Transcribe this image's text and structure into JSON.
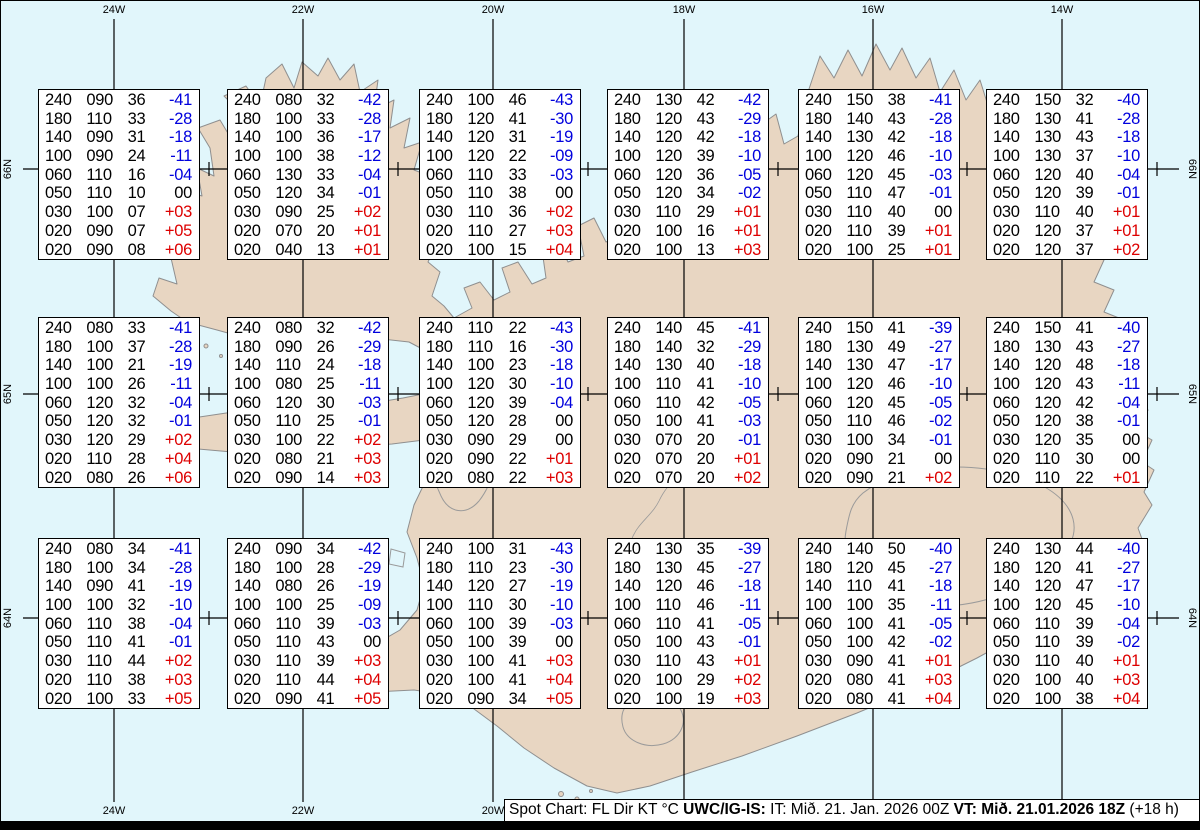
{
  "map": {
    "region": "Iceland",
    "colors": {
      "sea": "#e1f6fb",
      "land": "#e8d6c2",
      "coast": "#8f8f8f",
      "grid_line": "#000000",
      "temp_negative": "#0000dd",
      "temp_positive": "#dd0000",
      "temp_zero": "#000000"
    }
  },
  "grid": {
    "top_labels": [
      "24W",
      "22W",
      "20W",
      "18W",
      "16W",
      "14W"
    ],
    "bottom_labels": [
      "24W",
      "22W",
      "20W",
      "18W",
      "16W",
      "14W"
    ],
    "left_labels": [
      "66N",
      "65N",
      "64N"
    ],
    "right_labels": [
      "66N",
      "65N",
      "64N"
    ]
  },
  "status_bar": {
    "legend": "Spot Chart: FL Dir KT °C ",
    "source": "UWC/IG-IS:",
    "issue_time": " IT: Mið. 21. Jan. 2026 00Z ",
    "valid_time": "VT: Mið. 21.01.2026 18Z",
    "lead_time": " (+18 h)"
  },
  "spot_columns": [
    "FL",
    "Dir",
    "KT",
    "°C"
  ],
  "boxes": [
    {
      "rows": [
        [
          "240",
          "090",
          "36",
          "-41"
        ],
        [
          "180",
          "110",
          "33",
          "-28"
        ],
        [
          "140",
          "090",
          "31",
          "-18"
        ],
        [
          "100",
          "090",
          "24",
          "-11"
        ],
        [
          "060",
          "110",
          "16",
          "-04"
        ],
        [
          "050",
          "110",
          "10",
          "00"
        ],
        [
          "030",
          "100",
          "07",
          "+03"
        ],
        [
          "020",
          "090",
          "07",
          "+05"
        ],
        [
          "020",
          "090",
          "08",
          "+06"
        ]
      ]
    },
    {
      "rows": [
        [
          "240",
          "080",
          "32",
          "-42"
        ],
        [
          "180",
          "100",
          "33",
          "-28"
        ],
        [
          "140",
          "100",
          "36",
          "-17"
        ],
        [
          "100",
          "100",
          "38",
          "-12"
        ],
        [
          "060",
          "130",
          "33",
          "-04"
        ],
        [
          "050",
          "120",
          "34",
          "-01"
        ],
        [
          "030",
          "090",
          "25",
          "+02"
        ],
        [
          "020",
          "070",
          "20",
          "+01"
        ],
        [
          "020",
          "040",
          "13",
          "+01"
        ]
      ]
    },
    {
      "rows": [
        [
          "240",
          "100",
          "46",
          "-43"
        ],
        [
          "180",
          "120",
          "41",
          "-30"
        ],
        [
          "140",
          "120",
          "31",
          "-19"
        ],
        [
          "100",
          "120",
          "22",
          "-09"
        ],
        [
          "060",
          "110",
          "33",
          "-03"
        ],
        [
          "050",
          "110",
          "38",
          "00"
        ],
        [
          "030",
          "110",
          "36",
          "+02"
        ],
        [
          "020",
          "110",
          "27",
          "+03"
        ],
        [
          "020",
          "100",
          "15",
          "+04"
        ]
      ]
    },
    {
      "rows": [
        [
          "240",
          "130",
          "42",
          "-42"
        ],
        [
          "180",
          "120",
          "43",
          "-29"
        ],
        [
          "140",
          "120",
          "42",
          "-18"
        ],
        [
          "100",
          "120",
          "39",
          "-10"
        ],
        [
          "060",
          "120",
          "36",
          "-05"
        ],
        [
          "050",
          "120",
          "34",
          "-02"
        ],
        [
          "030",
          "110",
          "29",
          "+01"
        ],
        [
          "020",
          "100",
          "16",
          "+01"
        ],
        [
          "020",
          "100",
          "13",
          "+03"
        ]
      ]
    },
    {
      "rows": [
        [
          "240",
          "150",
          "38",
          "-41"
        ],
        [
          "180",
          "140",
          "43",
          "-28"
        ],
        [
          "140",
          "130",
          "42",
          "-18"
        ],
        [
          "100",
          "120",
          "46",
          "-10"
        ],
        [
          "060",
          "120",
          "45",
          "-03"
        ],
        [
          "050",
          "110",
          "47",
          "-01"
        ],
        [
          "030",
          "110",
          "40",
          "00"
        ],
        [
          "020",
          "110",
          "39",
          "+01"
        ],
        [
          "020",
          "100",
          "25",
          "+01"
        ]
      ]
    },
    {
      "rows": [
        [
          "240",
          "150",
          "32",
          "-40"
        ],
        [
          "180",
          "130",
          "41",
          "-28"
        ],
        [
          "140",
          "130",
          "43",
          "-18"
        ],
        [
          "100",
          "130",
          "37",
          "-10"
        ],
        [
          "060",
          "120",
          "40",
          "-04"
        ],
        [
          "050",
          "120",
          "39",
          "-01"
        ],
        [
          "030",
          "110",
          "40",
          "+01"
        ],
        [
          "020",
          "120",
          "37",
          "+01"
        ],
        [
          "020",
          "120",
          "37",
          "+02"
        ]
      ]
    },
    {
      "rows": [
        [
          "240",
          "080",
          "33",
          "-41"
        ],
        [
          "180",
          "100",
          "37",
          "-28"
        ],
        [
          "140",
          "100",
          "21",
          "-19"
        ],
        [
          "100",
          "100",
          "26",
          "-11"
        ],
        [
          "060",
          "120",
          "32",
          "-04"
        ],
        [
          "050",
          "120",
          "32",
          "-01"
        ],
        [
          "030",
          "120",
          "29",
          "+02"
        ],
        [
          "020",
          "110",
          "28",
          "+04"
        ],
        [
          "020",
          "080",
          "26",
          "+06"
        ]
      ]
    },
    {
      "rows": [
        [
          "240",
          "080",
          "32",
          "-42"
        ],
        [
          "180",
          "090",
          "26",
          "-29"
        ],
        [
          "140",
          "110",
          "24",
          "-18"
        ],
        [
          "100",
          "080",
          "25",
          "-11"
        ],
        [
          "060",
          "120",
          "30",
          "-03"
        ],
        [
          "050",
          "110",
          "25",
          "-01"
        ],
        [
          "030",
          "100",
          "22",
          "+02"
        ],
        [
          "020",
          "080",
          "21",
          "+03"
        ],
        [
          "020",
          "090",
          "14",
          "+03"
        ]
      ]
    },
    {
      "rows": [
        [
          "240",
          "110",
          "22",
          "-43"
        ],
        [
          "180",
          "110",
          "16",
          "-30"
        ],
        [
          "140",
          "100",
          "23",
          "-18"
        ],
        [
          "100",
          "120",
          "30",
          "-10"
        ],
        [
          "060",
          "120",
          "39",
          "-04"
        ],
        [
          "050",
          "120",
          "28",
          "00"
        ],
        [
          "030",
          "090",
          "29",
          "00"
        ],
        [
          "020",
          "090",
          "22",
          "+01"
        ],
        [
          "020",
          "080",
          "22",
          "+03"
        ]
      ]
    },
    {
      "rows": [
        [
          "240",
          "140",
          "45",
          "-41"
        ],
        [
          "180",
          "140",
          "32",
          "-29"
        ],
        [
          "140",
          "130",
          "40",
          "-18"
        ],
        [
          "100",
          "110",
          "41",
          "-10"
        ],
        [
          "060",
          "110",
          "42",
          "-05"
        ],
        [
          "050",
          "100",
          "41",
          "-03"
        ],
        [
          "030",
          "070",
          "20",
          "-01"
        ],
        [
          "020",
          "070",
          "20",
          "+01"
        ],
        [
          "020",
          "070",
          "20",
          "+02"
        ]
      ]
    },
    {
      "rows": [
        [
          "240",
          "150",
          "41",
          "-39"
        ],
        [
          "180",
          "130",
          "49",
          "-27"
        ],
        [
          "140",
          "130",
          "47",
          "-17"
        ],
        [
          "100",
          "120",
          "46",
          "-10"
        ],
        [
          "060",
          "120",
          "45",
          "-05"
        ],
        [
          "050",
          "110",
          "46",
          "-02"
        ],
        [
          "030",
          "100",
          "34",
          "-01"
        ],
        [
          "020",
          "090",
          "21",
          "00"
        ],
        [
          "020",
          "090",
          "21",
          "+02"
        ]
      ]
    },
    {
      "rows": [
        [
          "240",
          "150",
          "41",
          "-40"
        ],
        [
          "180",
          "130",
          "43",
          "-27"
        ],
        [
          "140",
          "120",
          "48",
          "-18"
        ],
        [
          "100",
          "120",
          "43",
          "-11"
        ],
        [
          "060",
          "120",
          "42",
          "-04"
        ],
        [
          "050",
          "120",
          "38",
          "-01"
        ],
        [
          "030",
          "120",
          "35",
          "00"
        ],
        [
          "020",
          "110",
          "30",
          "00"
        ],
        [
          "020",
          "110",
          "22",
          "+01"
        ]
      ]
    },
    {
      "rows": [
        [
          "240",
          "080",
          "34",
          "-41"
        ],
        [
          "180",
          "100",
          "34",
          "-28"
        ],
        [
          "140",
          "090",
          "41",
          "-19"
        ],
        [
          "100",
          "100",
          "32",
          "-10"
        ],
        [
          "060",
          "110",
          "38",
          "-04"
        ],
        [
          "050",
          "110",
          "41",
          "-01"
        ],
        [
          "030",
          "110",
          "44",
          "+02"
        ],
        [
          "020",
          "110",
          "38",
          "+03"
        ],
        [
          "020",
          "100",
          "33",
          "+05"
        ]
      ]
    },
    {
      "rows": [
        [
          "240",
          "090",
          "34",
          "-42"
        ],
        [
          "180",
          "100",
          "28",
          "-29"
        ],
        [
          "140",
          "080",
          "26",
          "-19"
        ],
        [
          "100",
          "100",
          "25",
          "-09"
        ],
        [
          "060",
          "110",
          "39",
          "-03"
        ],
        [
          "050",
          "110",
          "43",
          "00"
        ],
        [
          "030",
          "110",
          "39",
          "+03"
        ],
        [
          "020",
          "110",
          "44",
          "+04"
        ],
        [
          "020",
          "090",
          "41",
          "+05"
        ]
      ]
    },
    {
      "rows": [
        [
          "240",
          "100",
          "31",
          "-43"
        ],
        [
          "180",
          "110",
          "23",
          "-30"
        ],
        [
          "140",
          "120",
          "27",
          "-19"
        ],
        [
          "100",
          "110",
          "30",
          "-10"
        ],
        [
          "060",
          "100",
          "39",
          "-03"
        ],
        [
          "050",
          "100",
          "39",
          "00"
        ],
        [
          "030",
          "100",
          "41",
          "+03"
        ],
        [
          "020",
          "100",
          "41",
          "+04"
        ],
        [
          "020",
          "090",
          "34",
          "+05"
        ]
      ]
    },
    {
      "rows": [
        [
          "240",
          "130",
          "35",
          "-39"
        ],
        [
          "180",
          "130",
          "45",
          "-27"
        ],
        [
          "140",
          "120",
          "46",
          "-18"
        ],
        [
          "100",
          "110",
          "46",
          "-11"
        ],
        [
          "060",
          "110",
          "41",
          "-05"
        ],
        [
          "050",
          "100",
          "43",
          "-01"
        ],
        [
          "030",
          "110",
          "43",
          "+01"
        ],
        [
          "020",
          "100",
          "29",
          "+02"
        ],
        [
          "020",
          "100",
          "19",
          "+03"
        ]
      ]
    },
    {
      "rows": [
        [
          "240",
          "140",
          "50",
          "-40"
        ],
        [
          "180",
          "120",
          "45",
          "-27"
        ],
        [
          "140",
          "110",
          "41",
          "-18"
        ],
        [
          "100",
          "100",
          "35",
          "-11"
        ],
        [
          "060",
          "100",
          "41",
          "-05"
        ],
        [
          "050",
          "100",
          "42",
          "-02"
        ],
        [
          "030",
          "090",
          "41",
          "+01"
        ],
        [
          "020",
          "080",
          "41",
          "+03"
        ],
        [
          "020",
          "080",
          "41",
          "+04"
        ]
      ]
    },
    {
      "rows": [
        [
          "240",
          "130",
          "44",
          "-40"
        ],
        [
          "180",
          "120",
          "41",
          "-27"
        ],
        [
          "140",
          "120",
          "47",
          "-17"
        ],
        [
          "100",
          "120",
          "45",
          "-10"
        ],
        [
          "060",
          "110",
          "39",
          "-04"
        ],
        [
          "050",
          "110",
          "39",
          "-02"
        ],
        [
          "030",
          "110",
          "40",
          "+01"
        ],
        [
          "020",
          "100",
          "40",
          "+03"
        ],
        [
          "020",
          "100",
          "38",
          "+04"
        ]
      ]
    }
  ]
}
